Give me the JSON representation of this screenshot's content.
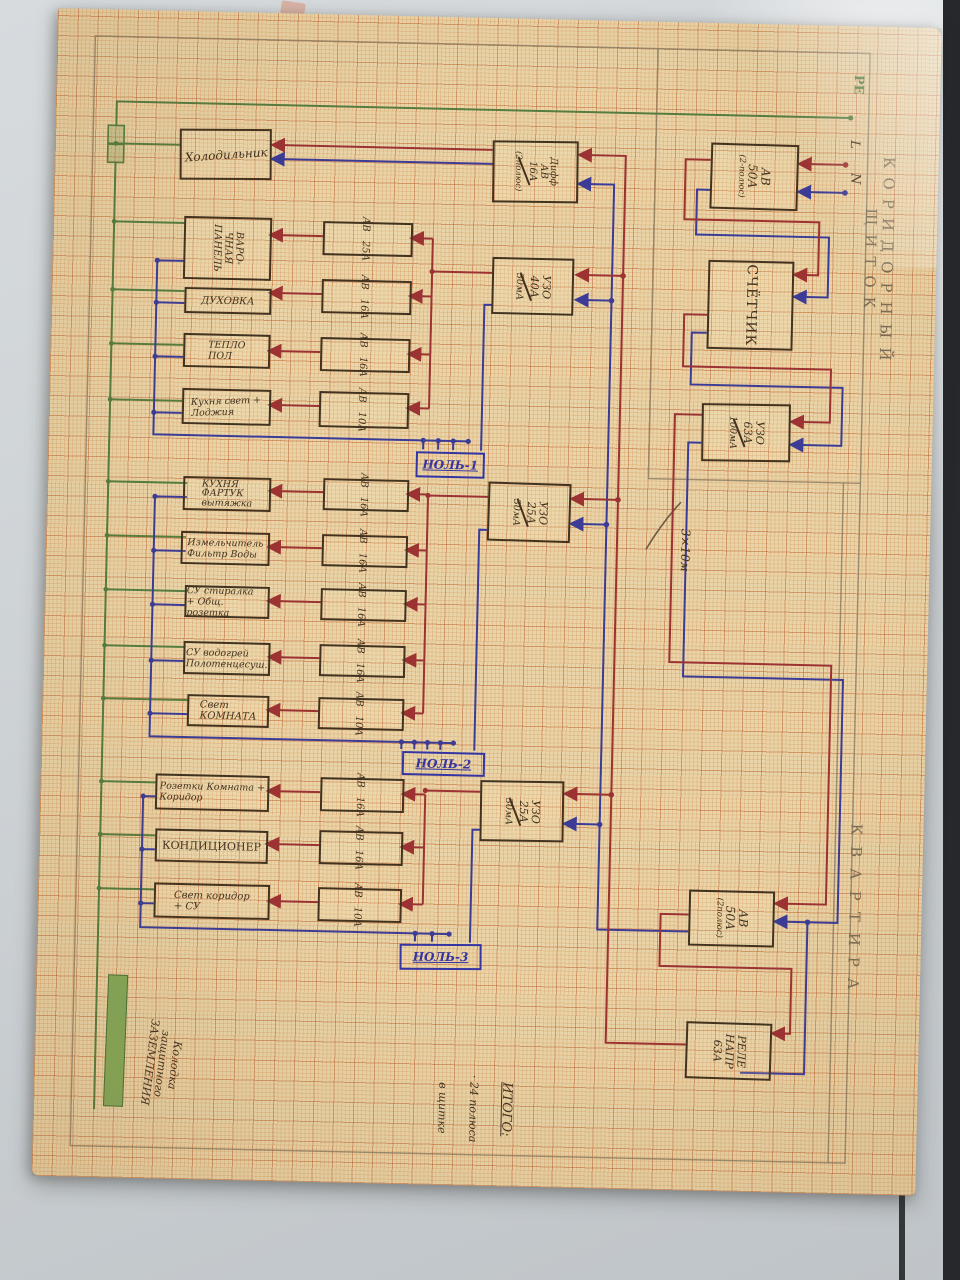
{
  "colors": {
    "paper": "#e9d5a9",
    "ink": "#42321f",
    "phase_wire": "#9c3232",
    "neutral_wire": "#3c3c96",
    "ground_wire": "#567c3e",
    "neutral_label": "#3434a2",
    "pencil": "#8a7960"
  },
  "titles": {
    "corridor_section": "КОРИДОРНЫЙ ЩИТОК",
    "apartment_section": "КВАРТИРА"
  },
  "entry": {
    "pe": "PE",
    "line": "L",
    "neutral": "N"
  },
  "corridor": {
    "breaker": {
      "l1": "АВ",
      "l2": "50А",
      "l3": "(2-полюс)"
    },
    "meter": "СЧЁТЧИК",
    "rcd": {
      "l1": "УЗО",
      "l2": "63А",
      "l3": "100мА"
    },
    "cable": "3×10м"
  },
  "apartment": {
    "breaker": {
      "l1": "АВ",
      "l2": "50А",
      "l3": "(2полюс)"
    },
    "relay": {
      "l1": "РЕЛЕ",
      "l2": "НАПР",
      "l3": "63А"
    },
    "diff": {
      "l1": "Дифф",
      "l2": "АВ",
      "l3": "16А",
      "l4": "(2полюс)"
    },
    "diff_load": "Холодильник",
    "groups": [
      {
        "rcd": {
          "l1": "УЗО",
          "l2": "40А",
          "l3": "30мА"
        },
        "neutral_bus": "НОЛЬ-1",
        "circuits": [
          {
            "b1": "АВ",
            "b2": "25А",
            "load": "ВАРО-\nЧНАЯ\nПАНЕЛЬ"
          },
          {
            "b1": "АВ",
            "b2": "16А",
            "load": "ДУХОВКА"
          },
          {
            "b1": "АВ",
            "b2": "16А",
            "load": "ТЕПЛО\nПОЛ"
          },
          {
            "b1": "АВ",
            "b2": "10А",
            "load": "Кухня свет +\nЛоджия"
          }
        ]
      },
      {
        "rcd": {
          "l1": "УЗО",
          "l2": "25А",
          "l3": "30мА"
        },
        "neutral_bus": "НОЛЬ-2",
        "circuits": [
          {
            "b1": "АВ",
            "b2": "16А",
            "load": "КУХНЯ\nФАРТУК\nвытяжка"
          },
          {
            "b1": "АВ",
            "b2": "16А",
            "load": "Измельчитель\nФильтр Воды"
          },
          {
            "b1": "АВ",
            "b2": "16А",
            "load": "СУ стиралка\n+ Общ. розетка"
          },
          {
            "b1": "АВ",
            "b2": "16А",
            "load": "СУ водогрей\nПолотенцесуш."
          },
          {
            "b1": "АВ",
            "b2": "10А",
            "load": "Свет\nКОМНАТА"
          }
        ]
      },
      {
        "rcd": {
          "l1": "УЗО",
          "l2": "25А",
          "l3": "30мА"
        },
        "neutral_bus": "НОЛЬ-3",
        "circuits": [
          {
            "b1": "АВ",
            "b2": "16А",
            "load": "Розетки Комната +\nКоридор"
          },
          {
            "b1": "АВ",
            "b2": "16А",
            "load": "КОНДИЦИОНЕР"
          },
          {
            "b1": "АВ",
            "b2": "10А",
            "load": "Свет коридор\n+ СУ"
          }
        ]
      }
    ]
  },
  "ground_block": {
    "label": "Колодка\nзащитного\nЗАЗЕМЛЕНИЯ"
  },
  "total": {
    "heading": "ИТОГО:",
    "line1": "· 24 полюса",
    "line2": "в щитке"
  }
}
